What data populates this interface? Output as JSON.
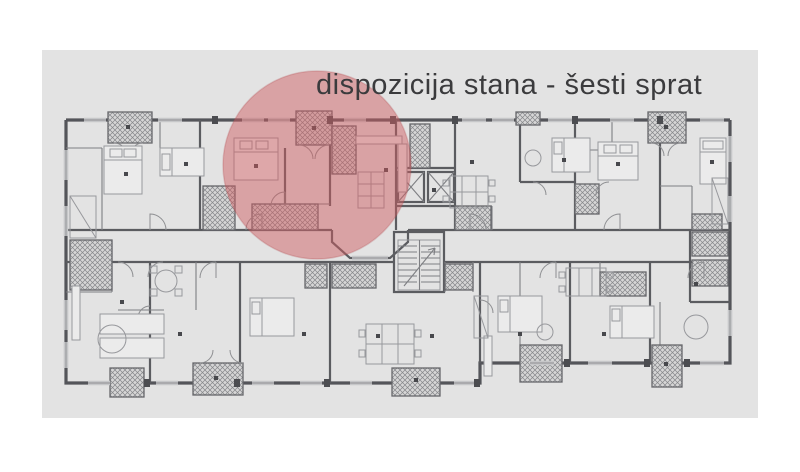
{
  "title": "dispozicija stana - šesti sprat",
  "colors": {
    "background": "#ffffff",
    "panel": "#e3e3e3",
    "wall": "#54555a",
    "partition": "#5b5c60",
    "thin_line": "#7e7f83",
    "furniture_line": "#97989c",
    "hatch_line": "#85868a",
    "highlight": "#ce5c60",
    "highlight_edge": "#b14a4f",
    "title_color": "#3b3b3d"
  },
  "highlight_circle": {
    "cx": 317,
    "cy": 165,
    "r": 94,
    "opacity": 0.48
  }
}
